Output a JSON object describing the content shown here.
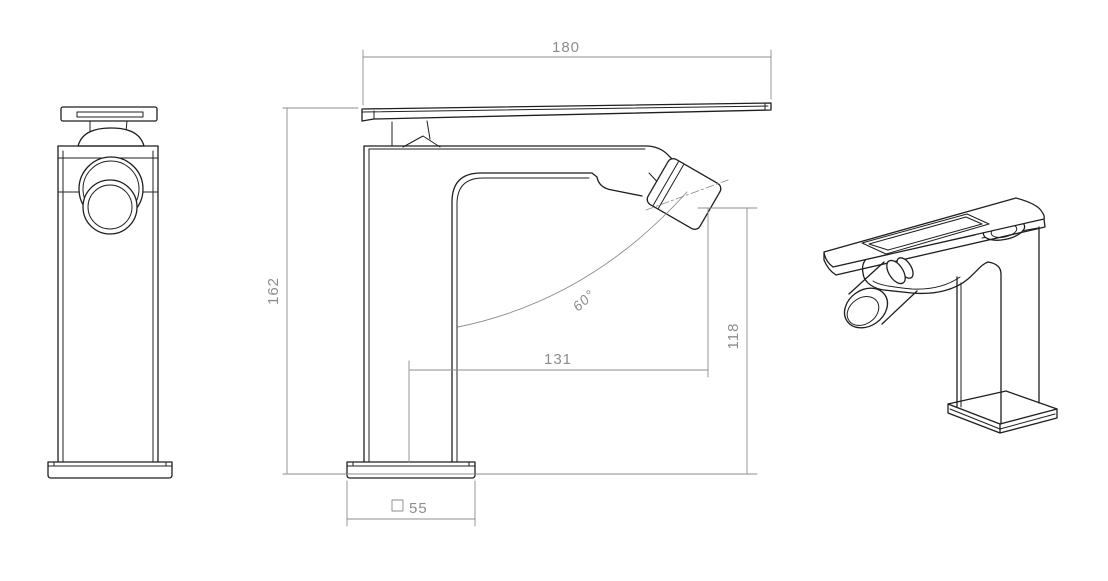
{
  "labels": {
    "top_width": "180",
    "overall_height": "162",
    "reach": "131",
    "outlet_height": "118",
    "spray_angle": "60°",
    "base_square": "55"
  },
  "colors": {
    "outline": "#1f1f1f",
    "dimension": "#8c8c8c",
    "background": "#ffffff"
  }
}
